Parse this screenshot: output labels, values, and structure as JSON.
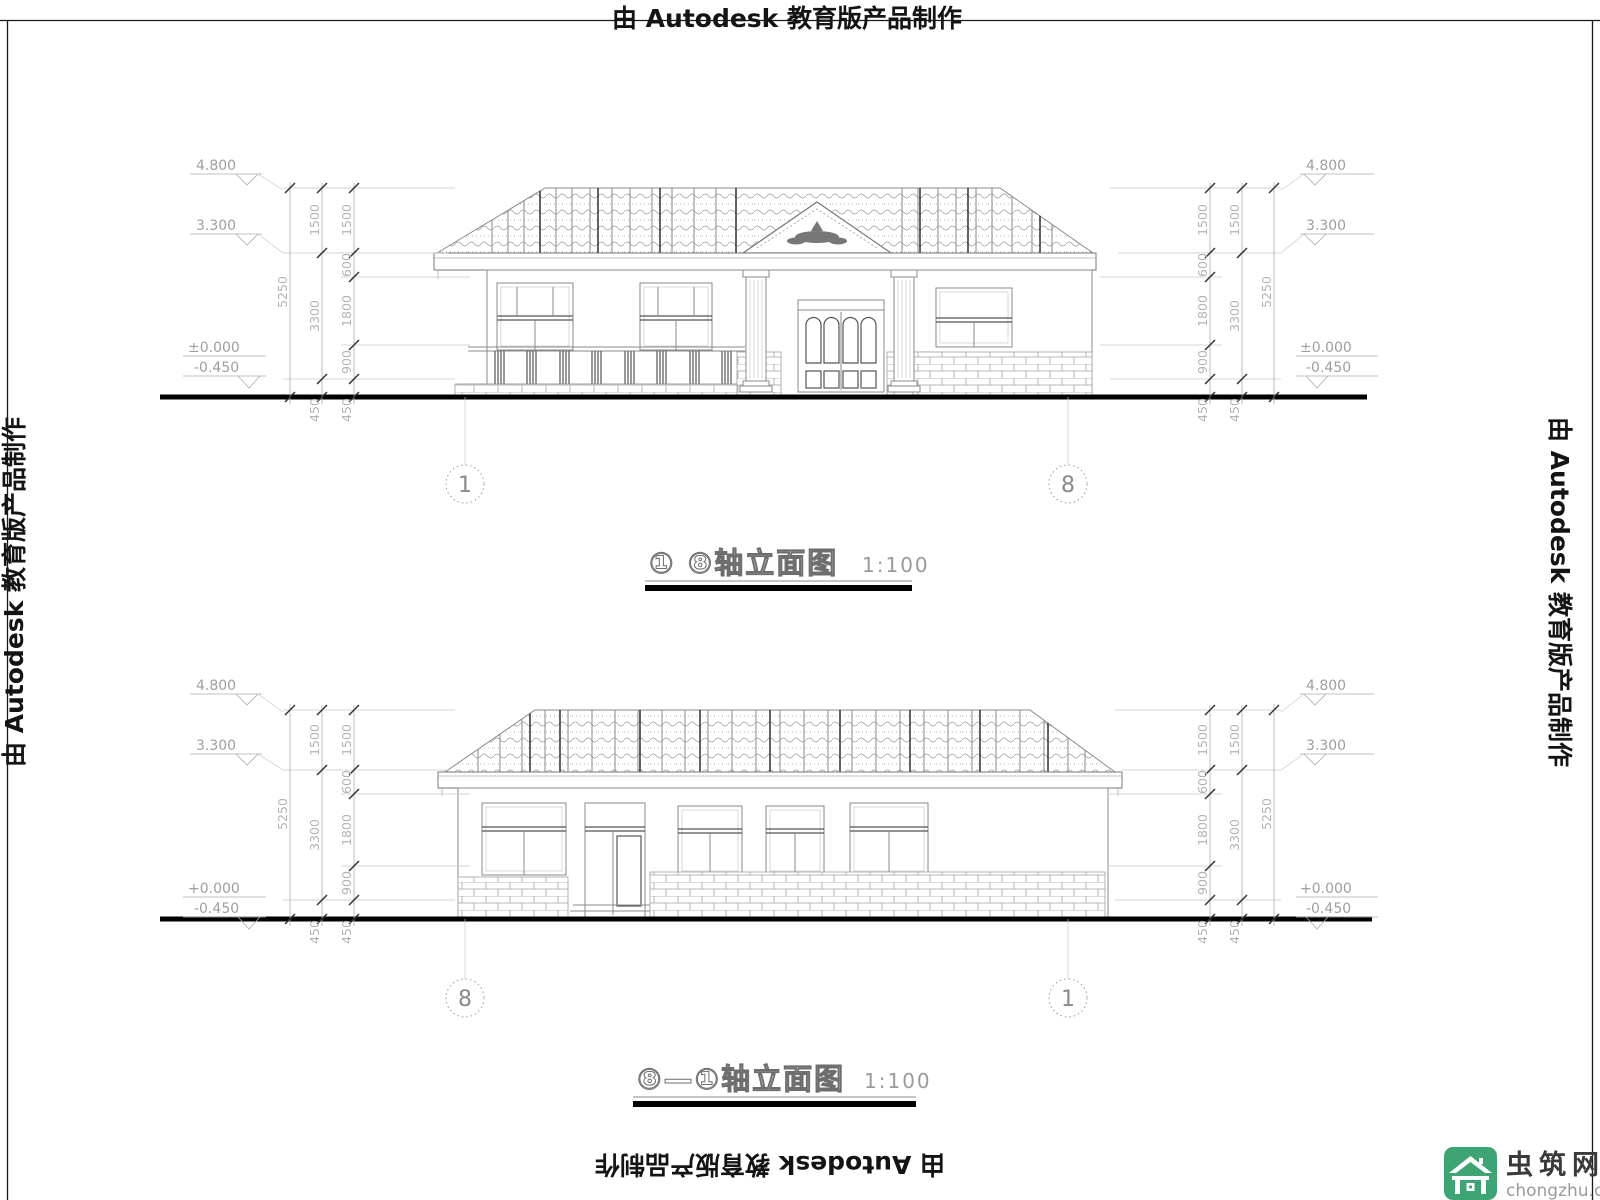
{
  "border": {
    "text": "由 Autodesk 教育版产品制作"
  },
  "logo": {
    "site_name": "虫筑网",
    "site_domain": "chongzhu.cn",
    "green": "#3fa473"
  },
  "levels": {
    "ridge": "4.800",
    "eave": "3.300",
    "zero": "±0.000",
    "zero_plus": "+0.000",
    "below": "-0.450"
  },
  "dims": {
    "d5250": "5250",
    "d3300": "3300",
    "d1500": "1500",
    "d600": "600",
    "d1800": "1800",
    "d900": "900",
    "d450": "450"
  },
  "axes": {
    "one": "1",
    "eight": "8"
  },
  "titles": {
    "front": {
      "label": "① ⑧轴立面图",
      "scale": "1:100"
    },
    "back": {
      "label": "⑧—①轴立面图",
      "scale": "1:100"
    }
  }
}
